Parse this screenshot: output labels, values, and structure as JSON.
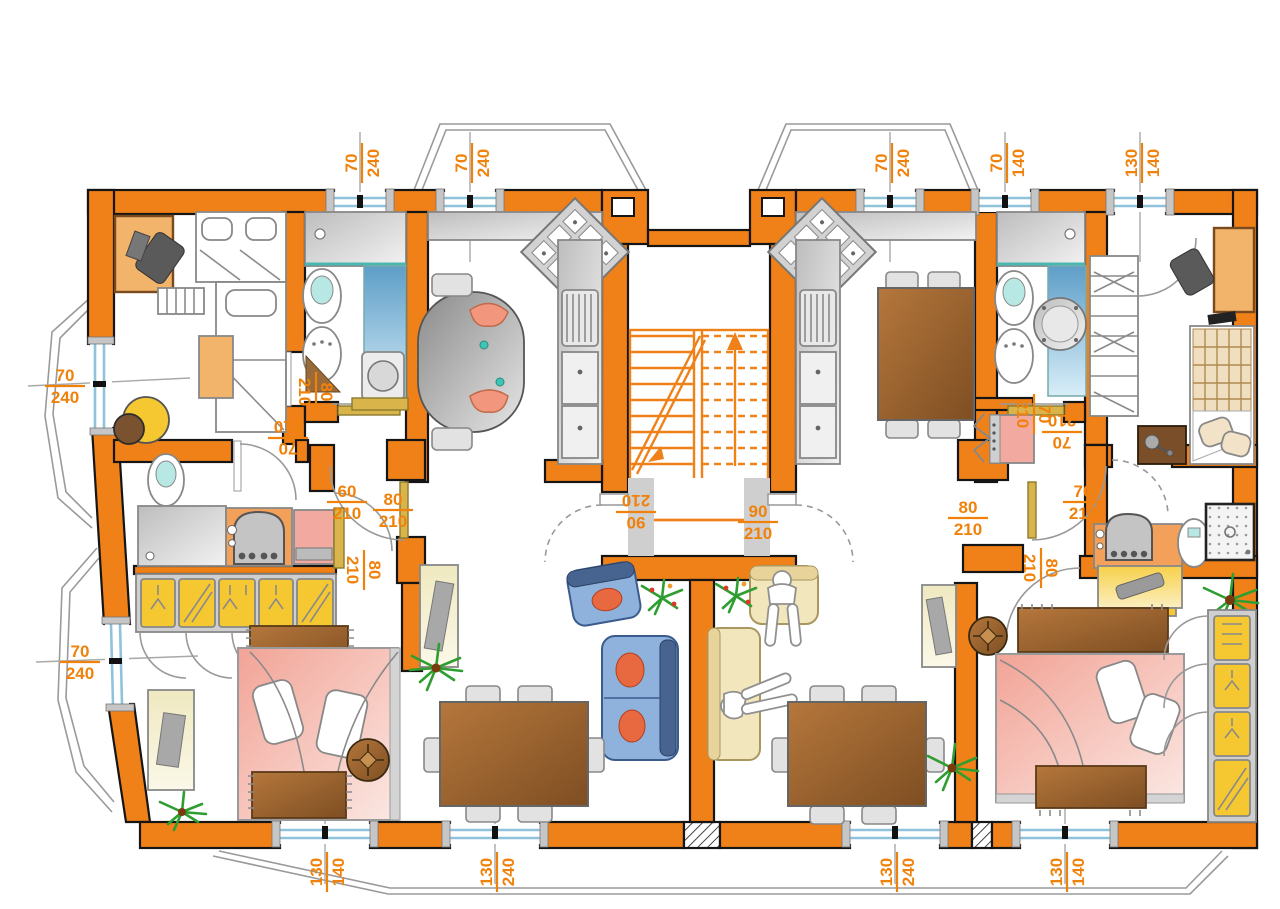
{
  "title": "apartment-floor-plan",
  "colors": {
    "wall": "#F08018",
    "dimension_text": "#F0820C",
    "window_glass": "#8FC3DC",
    "plant_green": "#2E9E30",
    "person_skin": "#F2977E",
    "cabinet_yellow": "#F5C832",
    "bed_pink": "#F2A396",
    "sofa_blue": "#8FB2DC",
    "wood_brown": "#A4ku6A30"
  },
  "dimension_labels": [
    {
      "id": "top-window-1",
      "num": "70",
      "den": "240",
      "x": 360,
      "y": 163,
      "rot": -90
    },
    {
      "id": "top-window-2",
      "num": "70",
      "den": "240",
      "x": 470,
      "y": 163,
      "rot": -90
    },
    {
      "id": "top-window-3",
      "num": "70",
      "den": "240",
      "x": 890,
      "y": 163,
      "rot": -90
    },
    {
      "id": "top-window-4",
      "num": "70",
      "den": "140",
      "x": 1005,
      "y": 163,
      "rot": -90
    },
    {
      "id": "top-window-5",
      "num": "130",
      "den": "140",
      "x": 1140,
      "y": 163,
      "rot": -90
    },
    {
      "id": "left-window-1",
      "num": "70",
      "den": "240",
      "x": 65,
      "y": 384,
      "rot": 0
    },
    {
      "id": "left-window-2",
      "num": "70",
      "den": "240",
      "x": 80,
      "y": 660,
      "rot": 0
    },
    {
      "id": "bottom-window-1",
      "num": "130",
      "den": "140",
      "x": 325,
      "y": 872,
      "rot": -90
    },
    {
      "id": "bottom-window-2",
      "num": "130",
      "den": "240",
      "x": 495,
      "y": 872,
      "rot": -90
    },
    {
      "id": "bottom-window-3",
      "num": "130",
      "den": "240",
      "x": 895,
      "y": 872,
      "rot": -90
    },
    {
      "id": "bottom-window-4",
      "num": "130",
      "den": "140",
      "x": 1065,
      "y": 872,
      "rot": -90
    },
    {
      "id": "left-bath1-door",
      "num": "80",
      "den": "210",
      "x": 318,
      "y": 392,
      "rot": 90
    },
    {
      "id": "left-bedroom-door",
      "num": "70",
      "den": "210",
      "x": 288,
      "y": 440,
      "rot": 180
    },
    {
      "id": "left-bath2-door",
      "num": "60",
      "den": "210",
      "x": 347,
      "y": 500,
      "rot": 0
    },
    {
      "id": "left-kitchen-door",
      "num": "80",
      "den": "210",
      "x": 393,
      "y": 508,
      "rot": 0
    },
    {
      "id": "left-bedroom2-door",
      "num": "80",
      "den": "210",
      "x": 366,
      "y": 570,
      "rot": 90
    },
    {
      "id": "stair-entry-left",
      "num": "90",
      "den": "210",
      "x": 636,
      "y": 514,
      "rot": 180
    },
    {
      "id": "stair-entry-right",
      "num": "90",
      "den": "210",
      "x": 758,
      "y": 520,
      "rot": 0
    },
    {
      "id": "right-hall-door",
      "num": "80",
      "den": "210",
      "x": 968,
      "y": 516,
      "rot": 0
    },
    {
      "id": "right-bath2-door",
      "num": "70",
      "den": "210",
      "x": 1083,
      "y": 500,
      "rot": 0
    },
    {
      "id": "right-bedroom2-door",
      "num": "80",
      "den": "210",
      "x": 1043,
      "y": 568,
      "rot": 90
    },
    {
      "id": "right-bath1-door",
      "num": "70",
      "den": "210",
      "x": 1036,
      "y": 414,
      "rot": 90
    },
    {
      "id": "right-bedroom-door",
      "num": "70",
      "den": "210",
      "x": 1062,
      "y": 434,
      "rot": 180
    }
  ]
}
